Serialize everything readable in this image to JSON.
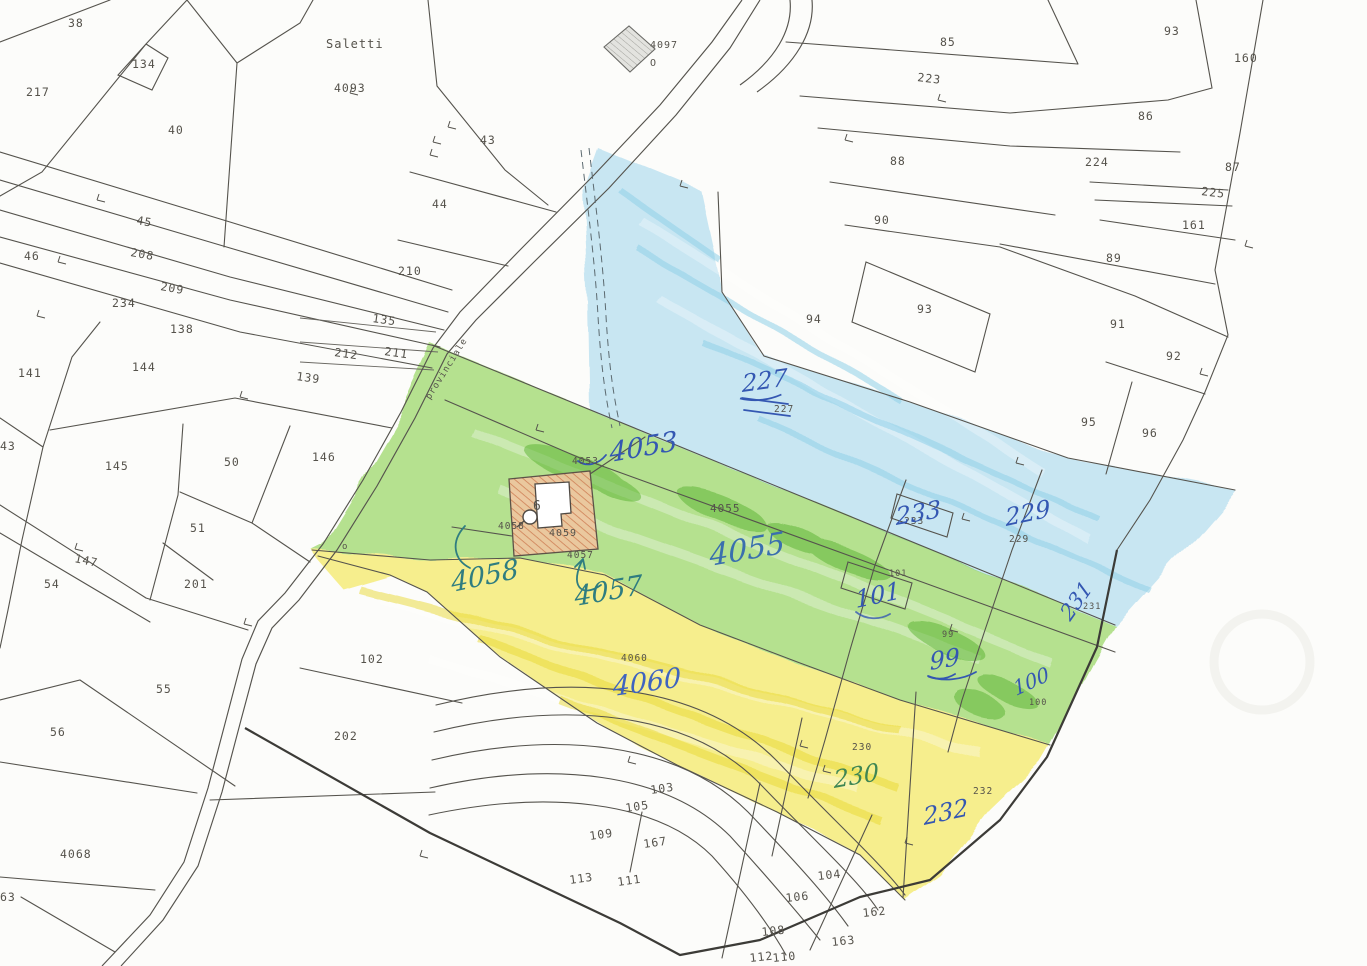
{
  "map": {
    "kind": "cadastral-parcel-map-scan",
    "colors": {
      "paper": "#fcfcfa",
      "line": "#55534d",
      "boundary_dark": "#3c3b37",
      "crayon_blue": "#a8d9ee",
      "crayon_green": "#86cf4a",
      "crayon_green_dark": "#57b02c",
      "crayon_yellow": "#f2e545",
      "building_fill": "#f0c6a0",
      "building_hatch": "#cf8057",
      "ink_blue": "#3457b2",
      "ink_teal": "#2f7d80",
      "ink_green": "#3f8653"
    },
    "place_name": "Saletti",
    "road_name": "provinciale",
    "building_number": "6",
    "printed_labels": [
      {
        "t": "38",
        "x": 68,
        "y": 27
      },
      {
        "t": "134",
        "x": 132,
        "y": 68
      },
      {
        "t": "217",
        "x": 26,
        "y": 96
      },
      {
        "t": "40",
        "x": 168,
        "y": 134
      },
      {
        "t": "4093",
        "x": 334,
        "y": 92
      },
      {
        "t": "Saletti",
        "x": 326,
        "y": 48,
        "s": 12,
        "ls": 4
      },
      {
        "t": "4097",
        "x": 650,
        "y": 48,
        "s": 10
      },
      {
        "t": "O",
        "x": 650,
        "y": 66,
        "s": 10
      },
      {
        "t": "43",
        "x": 480,
        "y": 144
      },
      {
        "t": "44",
        "x": 432,
        "y": 208
      },
      {
        "t": "210",
        "x": 398,
        "y": 275
      },
      {
        "t": "45",
        "x": 136,
        "y": 224,
        "r": 10
      },
      {
        "t": "208",
        "x": 130,
        "y": 256,
        "r": 10
      },
      {
        "t": "209",
        "x": 160,
        "y": 290,
        "r": 10
      },
      {
        "t": "46",
        "x": 24,
        "y": 260
      },
      {
        "t": "234",
        "x": 112,
        "y": 307
      },
      {
        "t": "138",
        "x": 170,
        "y": 333
      },
      {
        "t": "144",
        "x": 132,
        "y": 371
      },
      {
        "t": "141",
        "x": 18,
        "y": 377
      },
      {
        "t": "135",
        "x": 372,
        "y": 322,
        "r": 8
      },
      {
        "t": "212",
        "x": 334,
        "y": 356,
        "r": 8
      },
      {
        "t": "211",
        "x": 384,
        "y": 355,
        "r": 8
      },
      {
        "t": "139",
        "x": 296,
        "y": 380,
        "r": 8
      },
      {
        "t": "43",
        "x": 0,
        "y": 450
      },
      {
        "t": "145",
        "x": 105,
        "y": 470
      },
      {
        "t": "50",
        "x": 224,
        "y": 466
      },
      {
        "t": "146",
        "x": 312,
        "y": 461
      },
      {
        "t": "51",
        "x": 190,
        "y": 532
      },
      {
        "t": "147",
        "x": 74,
        "y": 562,
        "r": 12
      },
      {
        "t": "54",
        "x": 44,
        "y": 588
      },
      {
        "t": "201",
        "x": 184,
        "y": 588
      },
      {
        "t": "55",
        "x": 156,
        "y": 693
      },
      {
        "t": "56",
        "x": 50,
        "y": 736
      },
      {
        "t": "4068",
        "x": 60,
        "y": 858
      },
      {
        "t": "63",
        "x": 0,
        "y": 901
      },
      {
        "t": "102",
        "x": 360,
        "y": 663
      },
      {
        "t": "202",
        "x": 334,
        "y": 740
      },
      {
        "t": "85",
        "x": 940,
        "y": 46
      },
      {
        "t": "223",
        "x": 917,
        "y": 81,
        "r": 7
      },
      {
        "t": "93",
        "x": 1164,
        "y": 35
      },
      {
        "t": "160",
        "x": 1234,
        "y": 62
      },
      {
        "t": "86",
        "x": 1138,
        "y": 120
      },
      {
        "t": "224",
        "x": 1085,
        "y": 166
      },
      {
        "t": "87",
        "x": 1225,
        "y": 171
      },
      {
        "t": "225",
        "x": 1201,
        "y": 195,
        "r": 7
      },
      {
        "t": "161",
        "x": 1182,
        "y": 229
      },
      {
        "t": "88",
        "x": 890,
        "y": 165
      },
      {
        "t": "90",
        "x": 874,
        "y": 224
      },
      {
        "t": "89",
        "x": 1106,
        "y": 262
      },
      {
        "t": "94",
        "x": 806,
        "y": 323
      },
      {
        "t": "93",
        "x": 917,
        "y": 313
      },
      {
        "t": "91",
        "x": 1110,
        "y": 328
      },
      {
        "t": "92",
        "x": 1166,
        "y": 360
      },
      {
        "t": "95",
        "x": 1081,
        "y": 426
      },
      {
        "t": "96",
        "x": 1142,
        "y": 437
      },
      {
        "t": "227",
        "x": 774,
        "y": 412,
        "s": 9.5
      },
      {
        "t": "4053",
        "x": 572,
        "y": 464,
        "s": 9.5
      },
      {
        "t": "4055",
        "x": 710,
        "y": 512,
        "s": 11
      },
      {
        "t": "233",
        "x": 904,
        "y": 524,
        "s": 9.5
      },
      {
        "t": "229",
        "x": 1009,
        "y": 542,
        "s": 9.5
      },
      {
        "t": "101",
        "x": 889,
        "y": 576,
        "s": 8.5
      },
      {
        "t": "99",
        "x": 942,
        "y": 637,
        "s": 8.5
      },
      {
        "t": "100",
        "x": 1029,
        "y": 705,
        "s": 8.5
      },
      {
        "t": "231",
        "x": 1083,
        "y": 609,
        "s": 8.5
      },
      {
        "t": "4058",
        "x": 498,
        "y": 529,
        "s": 9.5
      },
      {
        "t": "4059",
        "x": 549,
        "y": 536,
        "s": 10
      },
      {
        "t": "4057",
        "x": 567,
        "y": 558,
        "s": 9.5
      },
      {
        "t": "4060",
        "x": 621,
        "y": 661,
        "s": 9.5
      },
      {
        "t": "230",
        "x": 852,
        "y": 750,
        "s": 9.5
      },
      {
        "t": "232",
        "x": 973,
        "y": 794,
        "s": 9.5
      },
      {
        "t": "103",
        "x": 651,
        "y": 794,
        "r": -8
      },
      {
        "t": "105",
        "x": 626,
        "y": 812,
        "r": -8
      },
      {
        "t": "109",
        "x": 590,
        "y": 840,
        "r": -8
      },
      {
        "t": "167",
        "x": 644,
        "y": 848,
        "r": -8
      },
      {
        "t": "113",
        "x": 570,
        "y": 884,
        "r": -8
      },
      {
        "t": "111",
        "x": 618,
        "y": 886,
        "r": -8
      },
      {
        "t": "104",
        "x": 818,
        "y": 880,
        "r": -6
      },
      {
        "t": "106",
        "x": 786,
        "y": 902,
        "r": -6
      },
      {
        "t": "162",
        "x": 863,
        "y": 917,
        "r": -6
      },
      {
        "t": "108",
        "x": 762,
        "y": 936,
        "r": -6
      },
      {
        "t": "163",
        "x": 832,
        "y": 946,
        "r": -6
      },
      {
        "t": "112",
        "x": 750,
        "y": 962,
        "r": -6
      },
      {
        "t": "110",
        "x": 773,
        "y": 962,
        "r": -6
      },
      {
        "t": "6",
        "x": 533,
        "y": 510,
        "s": 13
      },
      {
        "t": "o",
        "x": 342,
        "y": 549,
        "s": 9
      },
      {
        "t": "provinciale",
        "x": 430,
        "y": 400,
        "r": -58,
        "s": 9,
        "ls": 2
      }
    ],
    "handwritten_labels": [
      {
        "t": "227",
        "x": 742,
        "y": 392,
        "s": 24,
        "r": -8,
        "c": "#3457b2",
        "u": true
      },
      {
        "t": "4053",
        "x": 610,
        "y": 462,
        "s": 27,
        "r": -10,
        "c": "#3457b2"
      },
      {
        "t": "4055",
        "x": 710,
        "y": 566,
        "s": 30,
        "r": -10,
        "c": "#3a6fae"
      },
      {
        "t": "233",
        "x": 896,
        "y": 525,
        "s": 24,
        "r": -10,
        "c": "#3457b2"
      },
      {
        "t": "229",
        "x": 1006,
        "y": 526,
        "s": 24,
        "r": -12,
        "c": "#3457b2"
      },
      {
        "t": "231",
        "x": 1070,
        "y": 622,
        "s": 21,
        "r": -55,
        "c": "#3457b2"
      },
      {
        "t": "101",
        "x": 856,
        "y": 608,
        "s": 24,
        "r": -12,
        "c": "#3457b2"
      },
      {
        "t": "99",
        "x": 930,
        "y": 670,
        "s": 24,
        "r": -10,
        "c": "#3457b2",
        "u": true
      },
      {
        "t": "100",
        "x": 1016,
        "y": 696,
        "s": 20,
        "r": -25,
        "c": "#3457b2"
      },
      {
        "t": "4058",
        "x": 452,
        "y": 592,
        "s": 27,
        "r": -12,
        "c": "#2f7d80"
      },
      {
        "t": "4057",
        "x": 575,
        "y": 606,
        "s": 27,
        "r": -10,
        "c": "#2f7d80"
      },
      {
        "t": "4060",
        "x": 613,
        "y": 696,
        "s": 27,
        "r": -8,
        "c": "#3f64c0"
      },
      {
        "t": "230",
        "x": 834,
        "y": 788,
        "s": 24,
        "r": -10,
        "c": "#3f8653"
      },
      {
        "t": "232",
        "x": 924,
        "y": 825,
        "s": 24,
        "r": -12,
        "c": "#3457b2"
      }
    ]
  }
}
